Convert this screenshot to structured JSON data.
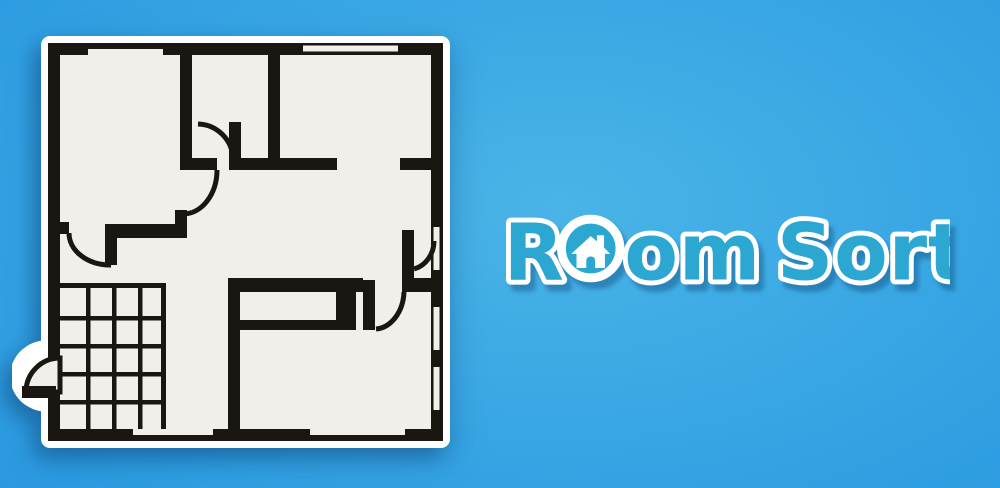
{
  "app": {
    "title": "Room Sort",
    "type_label": "game banner"
  },
  "logo": {
    "part1": "R",
    "part2": "om",
    "part3": "Sort",
    "house_icon": "house-icon"
  },
  "colors": {
    "wall": "#1a1611",
    "floor": "#f2eee9",
    "logo_fill": "#2ba7d1",
    "logo_outline": "#ffffff",
    "bg_center": "#4ab4e7",
    "bg_mid": "#2f9fe2",
    "bg_edge": "#1e89d8"
  },
  "floorplan": {
    "description": "apartment floor plan with 6 areas, 5 interior door swings, 1 exterior door, 7 windows, stair grid bottom-left and closet bottom-right",
    "wall_color": "#1a1611",
    "floor_color": "#f2eee9"
  }
}
